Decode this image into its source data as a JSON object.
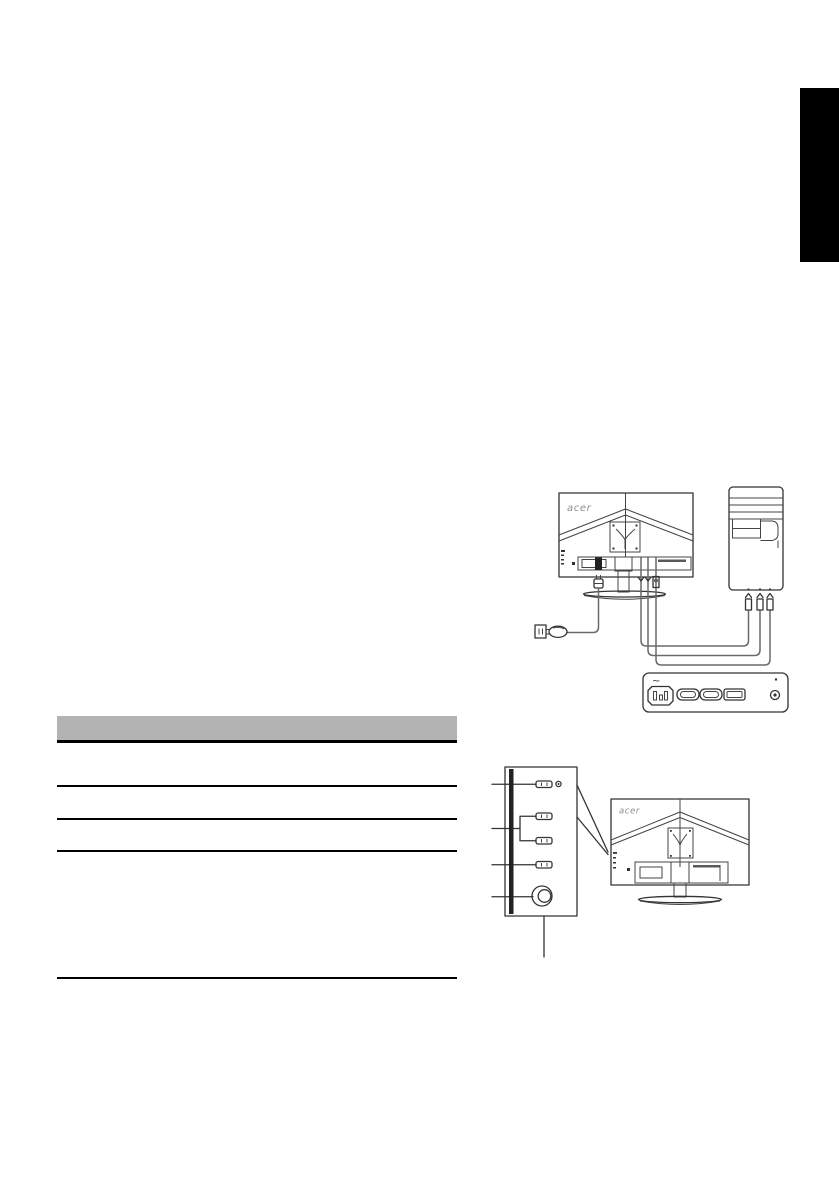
{
  "page": {
    "kind": "acer-monitor-user-guide-page",
    "background": "#ffffff",
    "language_tab": {
      "label": "",
      "color": "#000000"
    }
  },
  "connection_diagram": {
    "brand_logo": "acer",
    "ac_power_symbol": "~",
    "monitor": "monitor-rear-view",
    "computer": "desktop-pc-tower",
    "io_panel_ports": [
      "ac-power-inlet",
      "hdmi-1",
      "hdmi-2",
      "displayport",
      "audio-jack"
    ],
    "cables": [
      "power-cord-to-wall-plug",
      "signal-cable-1",
      "signal-cable-2",
      "signal-cable-3"
    ]
  },
  "controls_diagram": {
    "brand_logo": "acer",
    "panel_items": [
      "button-with-power-led",
      "hotkey-button-1",
      "hotkey-button-2",
      "input-button",
      "navi-joystick"
    ],
    "callout_count": 4
  },
  "spec_table": {
    "header_label": "",
    "rows": [
      "",
      "",
      "",
      ""
    ],
    "header_color": "#b3b3b3"
  }
}
